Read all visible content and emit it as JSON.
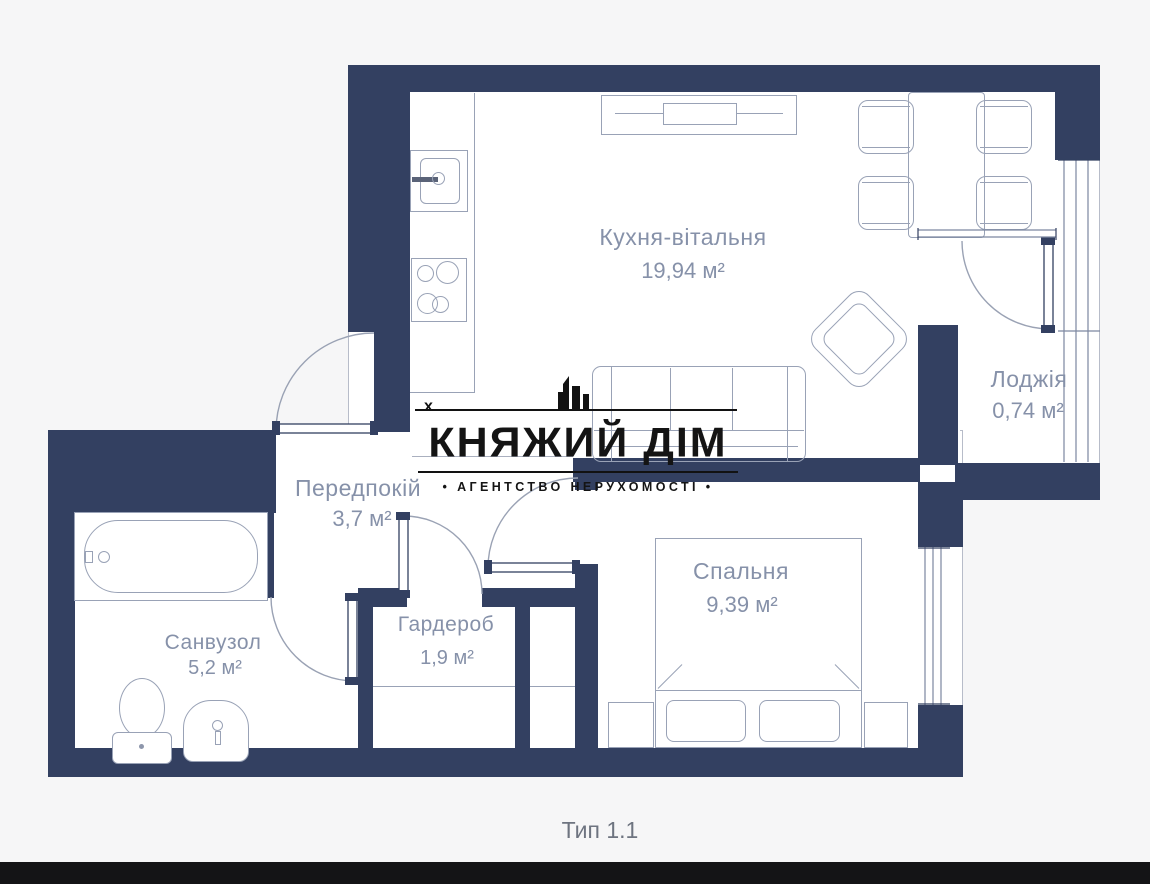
{
  "logo": {
    "title": "КНЯЖИЙ ДІМ",
    "subtitle": "• АГЕНТСТВО  НЕРУХОМОСТІ •",
    "marker": "х"
  },
  "plan": {
    "rooms": {
      "kitchen_living": {
        "name": "Кухня-вітальня",
        "area": "19,94 м²"
      },
      "loggia": {
        "name": "Лоджія",
        "area": "0,74 м²"
      },
      "hallway": {
        "name": "Передпокій",
        "area": "3,7 м²"
      },
      "bedroom": {
        "name": "Спальня",
        "area": "9,39 м²"
      },
      "bathroom": {
        "name": "Санвузол",
        "area": "5,2 м²"
      },
      "wardrobe": {
        "name": "Гардероб",
        "area": "1,9 м²"
      }
    },
    "type_label": "Тип 1.1"
  },
  "colors": {
    "wall": "#334061",
    "label": "#8691a9",
    "logo": "#141414"
  }
}
